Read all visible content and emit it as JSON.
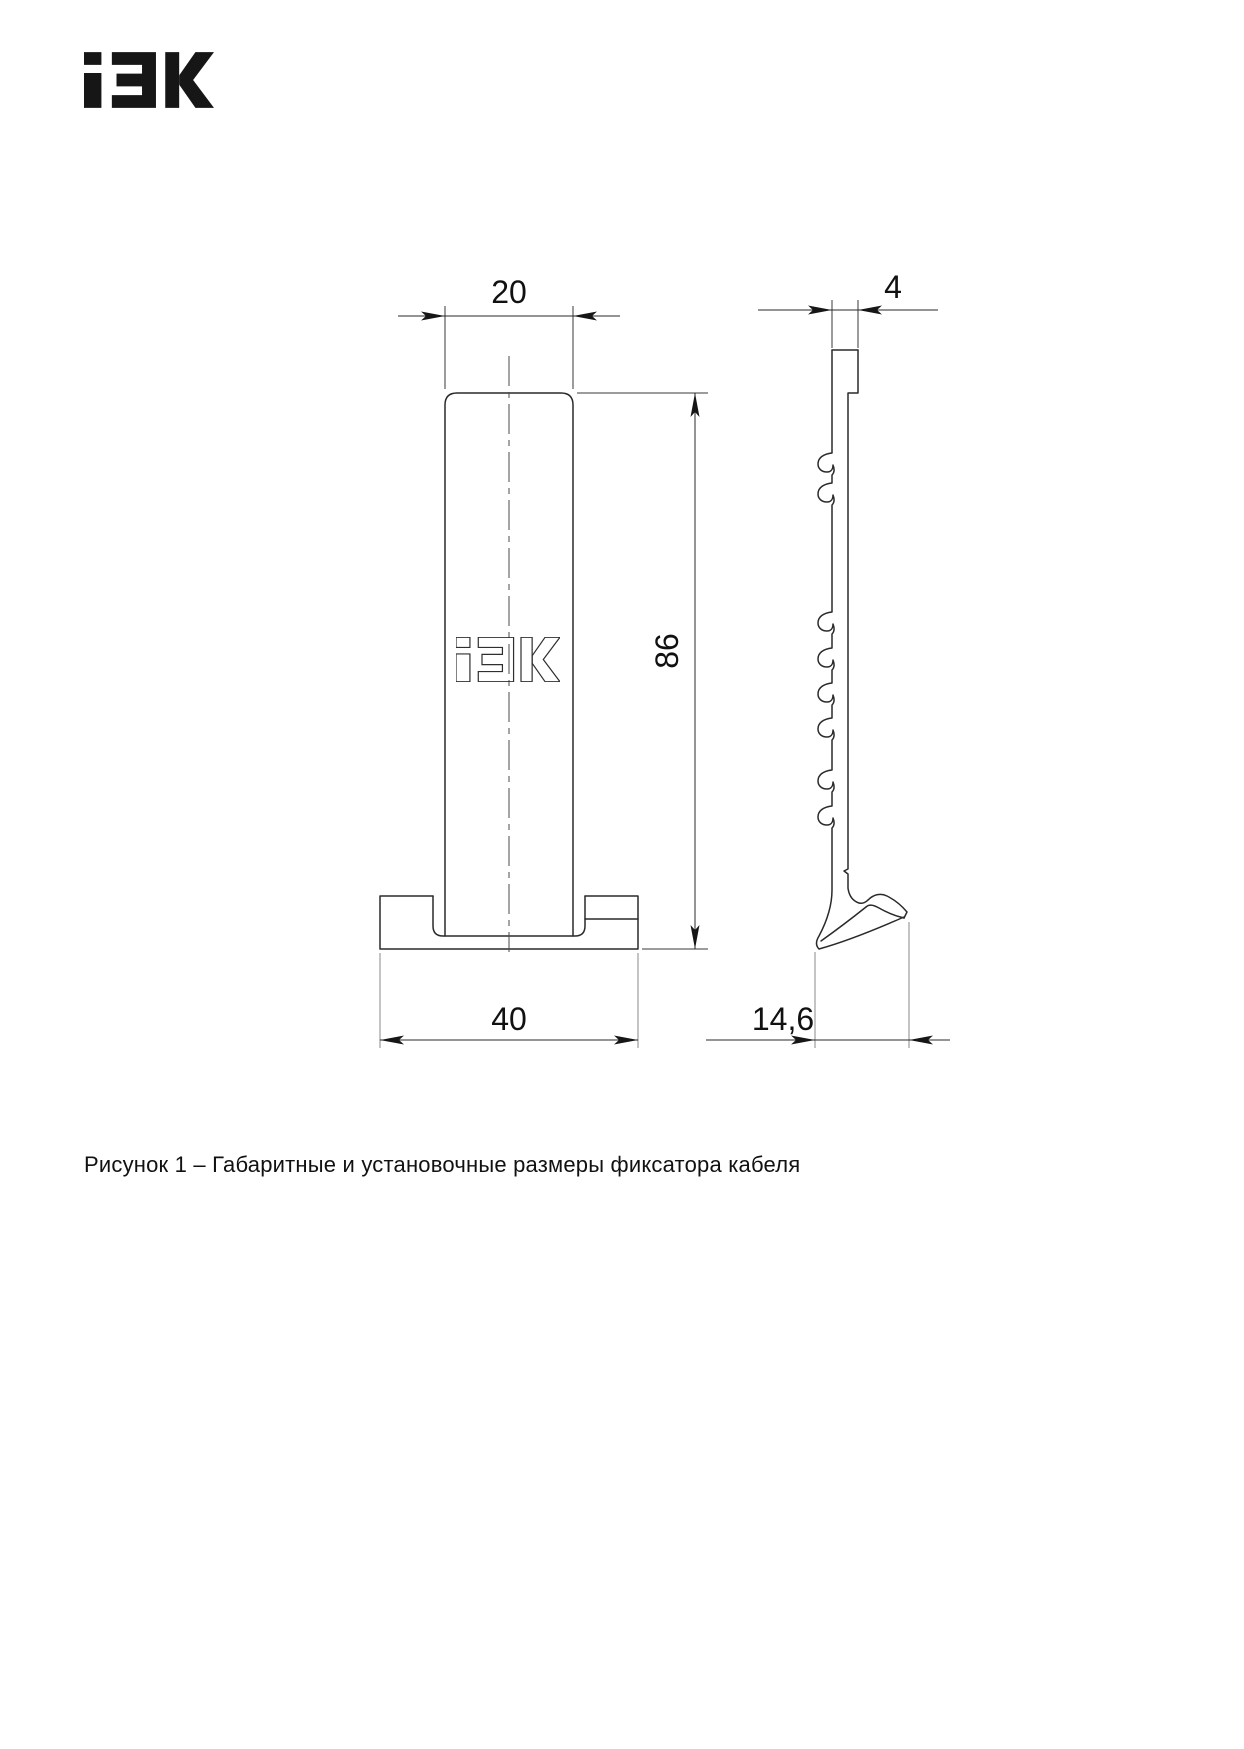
{
  "brand": {
    "name": "IEK"
  },
  "figure": {
    "caption": "Рисунок 1 – Габаритные и установочные размеры фиксатора кабеля",
    "number": "Рисунок 1"
  },
  "drawing": {
    "subject": "фиксатор кабеля",
    "front_view": {
      "top_width_label": "20",
      "height_label": "86",
      "base_width_label": "40"
    },
    "side_view": {
      "thickness_label": "4",
      "foot_depth_label": "14,6"
    }
  },
  "colors": {
    "background": "#ffffff",
    "outline": "#2a2a2a",
    "extension_line": "#8a8a8a",
    "text": "#111111"
  }
}
